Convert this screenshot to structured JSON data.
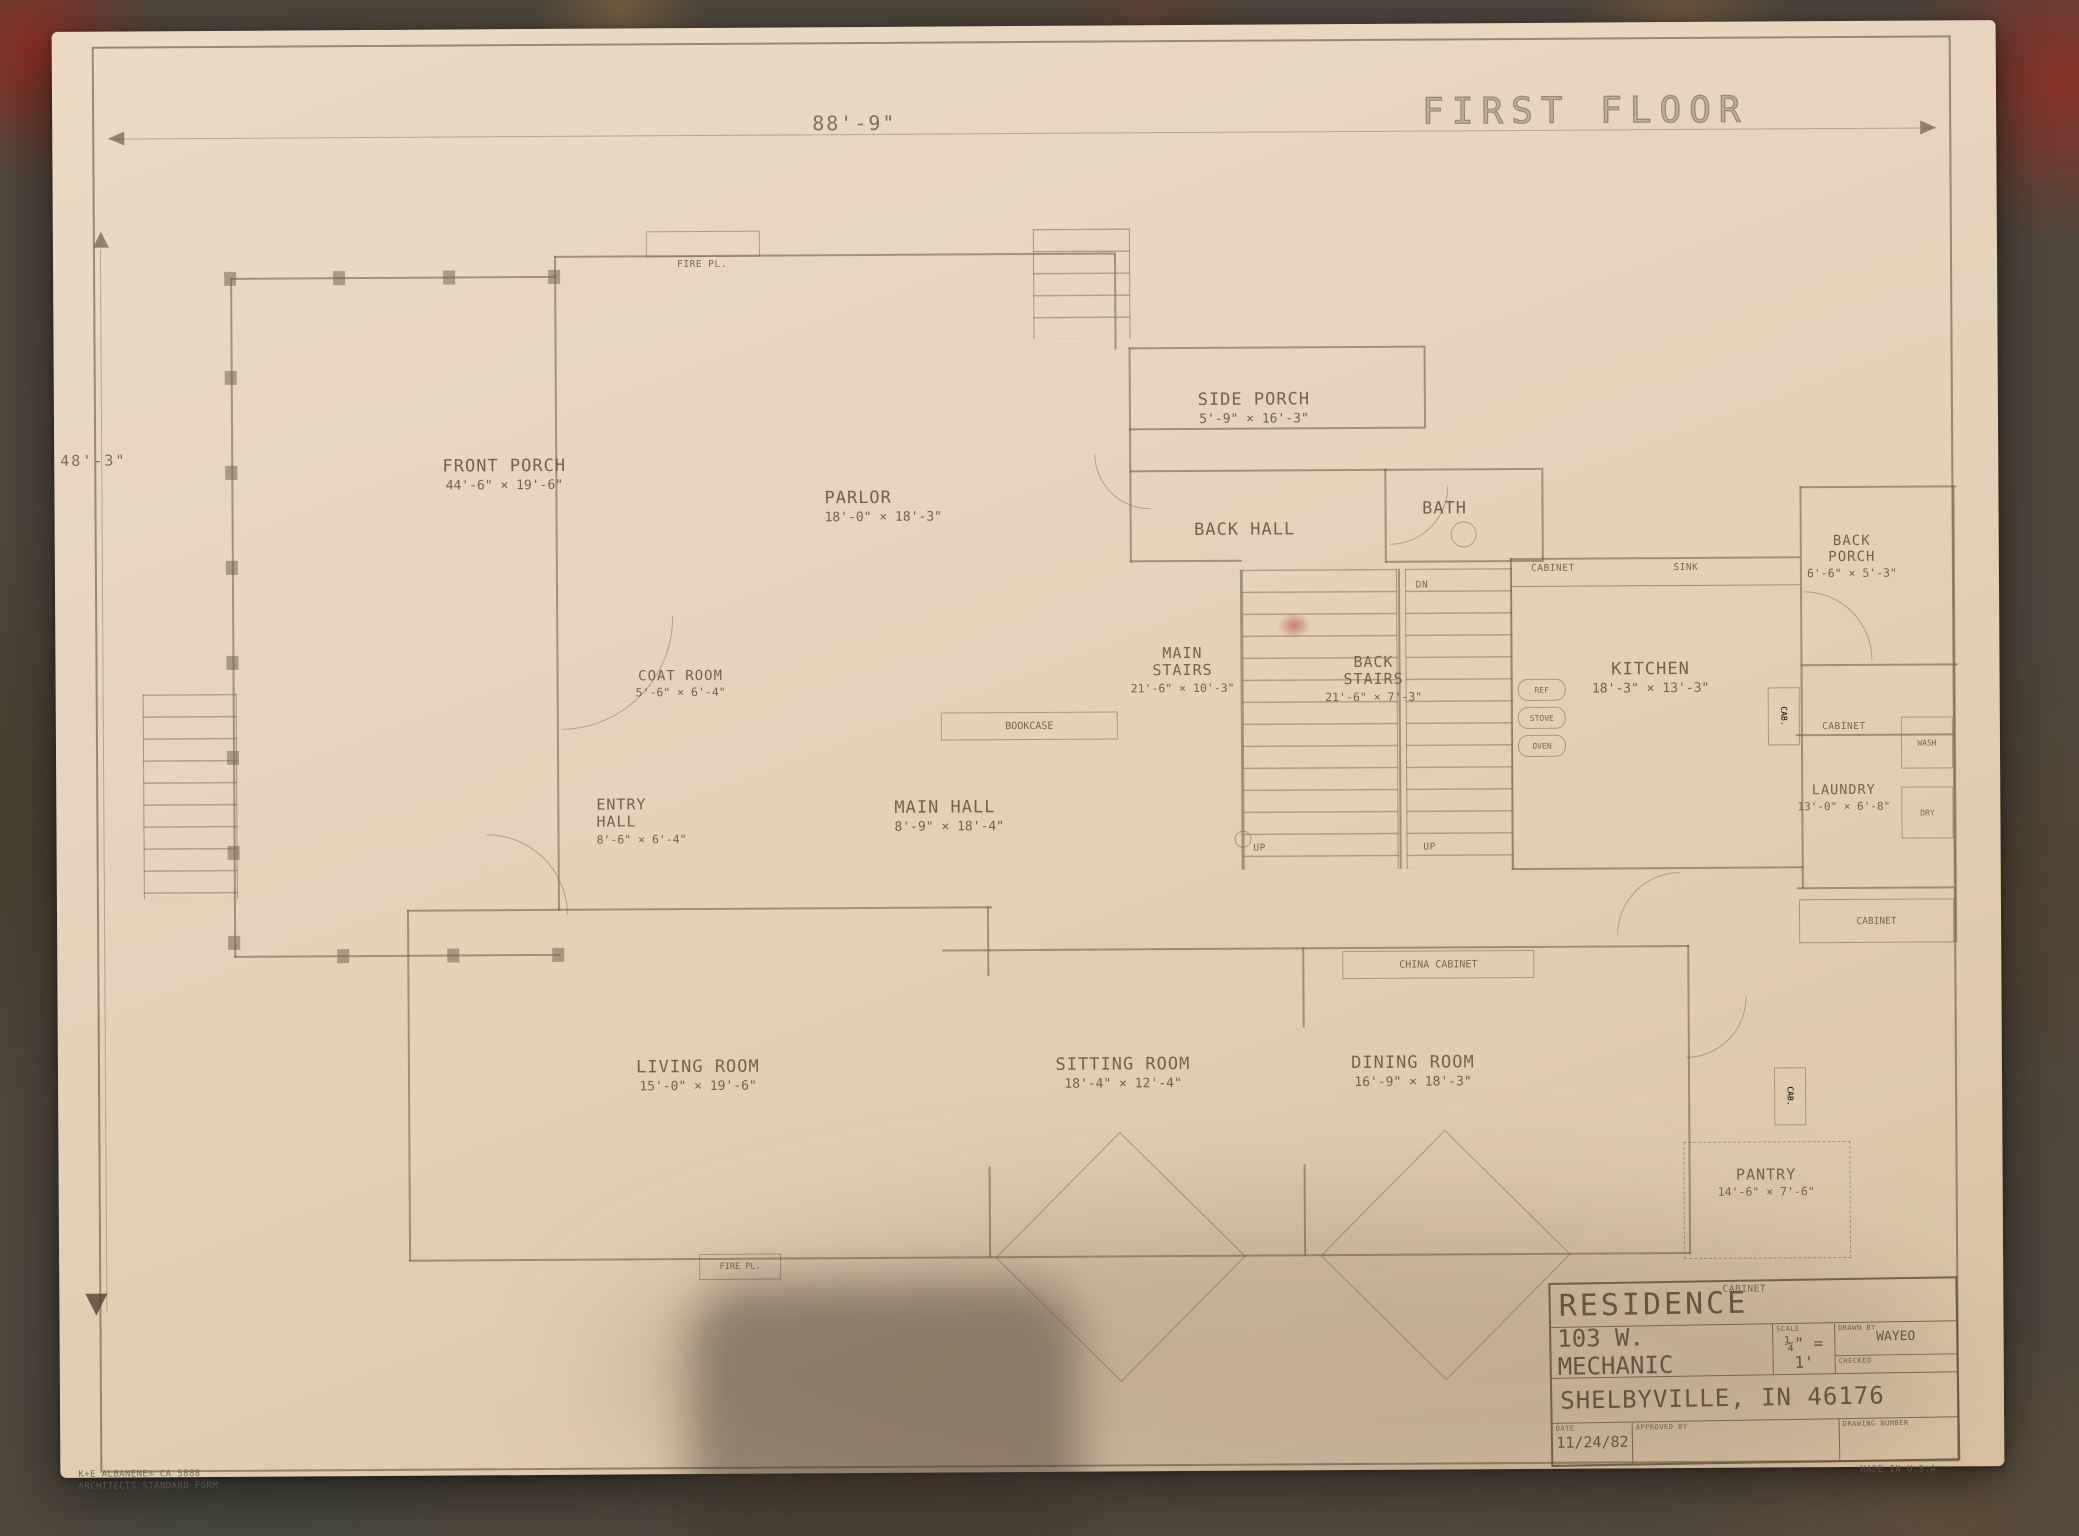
{
  "sheet": {
    "title": "FIRST FLOOR",
    "top_dimension": "88'-9\"",
    "left_dimension": "48'-3\"",
    "manufacturer_line1": "K+E ALBANENE® CA 5888",
    "manufacturer_line2": "ARCHITECTS STANDARD FORM",
    "made_in": "MADE IN U.S.A."
  },
  "rooms": [
    {
      "name": "FRONT PORCH",
      "dims": "44'-6\" × 19'-6\""
    },
    {
      "name": "PARLOR",
      "dims": "18'-0\" × 18'-3\""
    },
    {
      "name": "SIDE PORCH",
      "dims": "5'-9\" × 16'-3\""
    },
    {
      "name": "BACK HALL",
      "dims": ""
    },
    {
      "name": "BATH",
      "dims": ""
    },
    {
      "name": "MAIN STAIRS",
      "dims": "21'-6\" × 10'-3\""
    },
    {
      "name": "BACK STAIRS",
      "dims": "21'-6\" × 7'-3\""
    },
    {
      "name": "KITCHEN",
      "dims": "18'-3\" × 13'-3\""
    },
    {
      "name": "BACK PORCH",
      "dims": "6'-6\" × 5'-3\""
    },
    {
      "name": "COAT ROOM",
      "dims": "5'-6\" × 6'-4\""
    },
    {
      "name": "ENTRY HALL",
      "dims": "8'-6\" × 6'-4\""
    },
    {
      "name": "MAIN HALL",
      "dims": "8'-9\" × 18'-4\""
    },
    {
      "name": "LAUNDRY",
      "dims": "13'-0\" × 6'-8\""
    },
    {
      "name": "LIVING ROOM",
      "dims": "15'-0\" × 19'-6\""
    },
    {
      "name": "SITTING ROOM",
      "dims": "18'-4\" × 12'-4\""
    },
    {
      "name": "DINING ROOM",
      "dims": "16'-9\" × 18'-3\""
    },
    {
      "name": "PANTRY",
      "dims": "14'-6\" × 7'-6\""
    }
  ],
  "features": {
    "fire_pl": "FIRE PL.",
    "bookcase": "BOOKCASE",
    "china_cabinet": "CHINA CABINET",
    "cabinet": "CABINET",
    "cab": "CAB.",
    "wash": "WASH",
    "dry": "DRY",
    "sink": "SINK",
    "ref": "REF",
    "stove": "STOVE",
    "oven": "OVEN",
    "up": "UP",
    "dn": "DN"
  },
  "title_block": {
    "project": "RESIDENCE",
    "address": "103 W. MECHANIC",
    "city": "SHELBYVILLE, IN 46176",
    "scale_label": "SCALE",
    "scale_value": "¼\" = 1'",
    "drawn_by_label": "DRAWN BY",
    "drawn_by_value": "WAYEO",
    "checked_label": "CHECKED",
    "date_label": "DATE",
    "date_value": "11/24/82",
    "approved_label": "APPROVED BY",
    "drawing_number_label": "DRAWING NUMBER"
  },
  "colors": {
    "paper": "#e7d4bc",
    "carpet": "#4e463b",
    "pencil": "#7c6a55",
    "accent_red": "#7d2d22"
  }
}
